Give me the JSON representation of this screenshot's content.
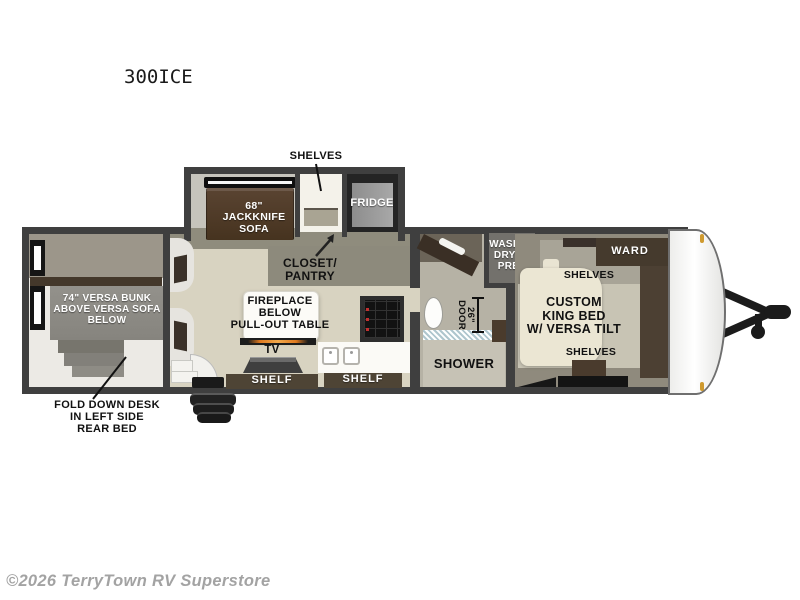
{
  "title": "300ICE",
  "watermark": "©2026 TerryTown RV Superstore",
  "colors": {
    "wall": "#3f3f3f",
    "floor_beige": "#d8d3c1",
    "wood_dark": "#4a3b2c",
    "marker_light": "#cf9a2f"
  },
  "slideout": {
    "shelves_label": "SHELVES",
    "sofa": [
      "68\"",
      "JACKKNIFE",
      "SOFA"
    ],
    "fridge_label": "FRIDGE"
  },
  "living": {
    "closet_pantry": [
      "CLOSET/",
      "PANTRY"
    ],
    "island": [
      "FIREPLACE",
      "BELOW",
      "PULL-OUT TABLE"
    ],
    "tv_label": "TV",
    "shelf_left_label": "SHELF",
    "shelf_right_label": "SHELF"
  },
  "rear_room": {
    "bunk": [
      "74\" VERSA BUNK",
      "ABOVE VERSA SOFA",
      "BELOW"
    ],
    "desk_note": [
      "FOLD DOWN DESK",
      "IN LEFT SIDE",
      "REAR BED"
    ]
  },
  "bathroom": {
    "washer_prep": [
      "WASHER",
      "DRYER",
      "PREP"
    ],
    "door_width": "26\"",
    "door_label": "DOOR",
    "shower_label": "SHOWER"
  },
  "bedroom": {
    "ward_label": "WARD",
    "shelves_top_label": "SHELVES",
    "bed": [
      "CUSTOM",
      "KING BED",
      "W/ VERSA TILT"
    ],
    "shelves_bottom_label": "SHELVES"
  }
}
